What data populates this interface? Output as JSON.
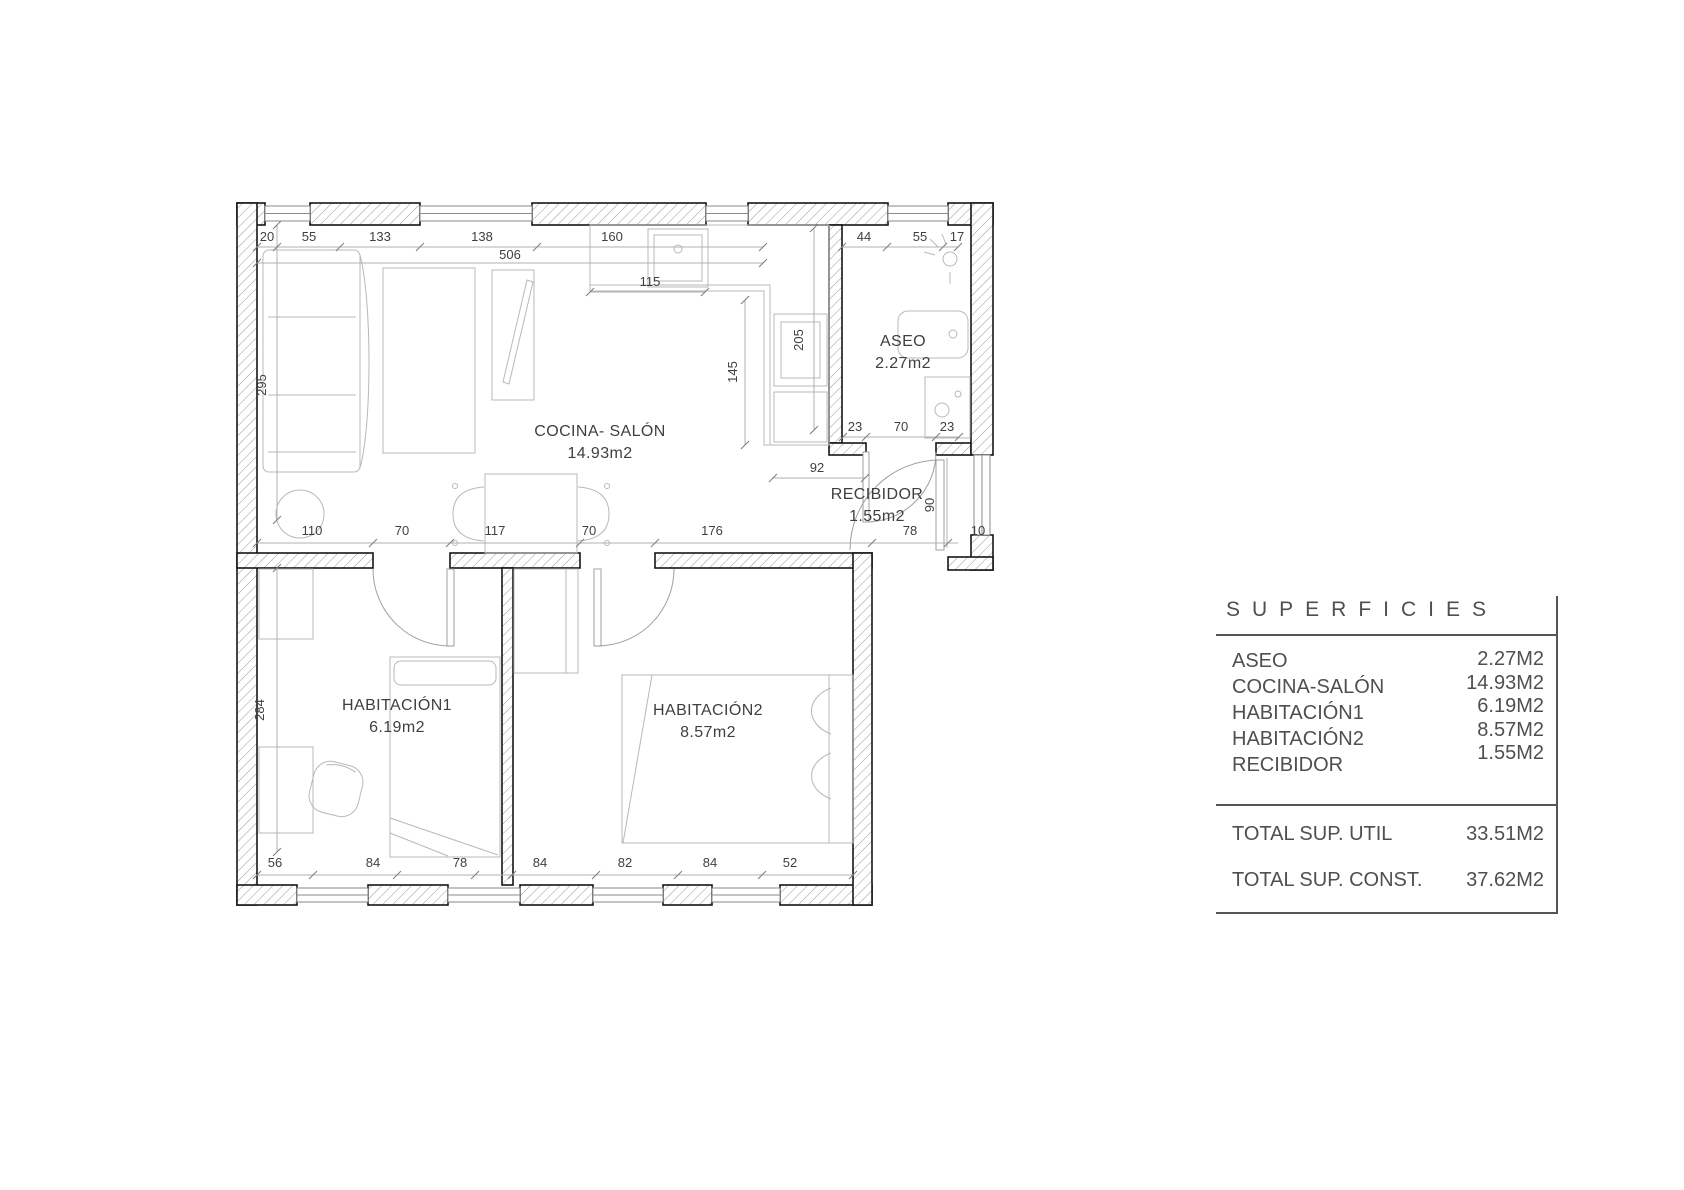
{
  "plan": {
    "rooms": {
      "cocina": {
        "name": "COCINA- SALÓN",
        "area": "14.93m2"
      },
      "aseo": {
        "name": "ASEO",
        "area": "2.27m2"
      },
      "recibidor": {
        "name": "RECIBIDOR",
        "area": "1.55m2"
      },
      "hab1": {
        "name": "HABITACIÓN1",
        "area": "6.19m2"
      },
      "hab2": {
        "name": "HABITACIÓN2",
        "area": "8.57m2"
      }
    },
    "dims": [
      "20",
      "55",
      "133",
      "138",
      "506",
      "160",
      "44",
      "55",
      "17",
      "295",
      "115",
      "205",
      "145",
      "23",
      "70",
      "23",
      "92",
      "90",
      "110",
      "70",
      "117",
      "70",
      "176",
      "78",
      "10",
      "284",
      "56",
      "84",
      "78",
      "84",
      "82",
      "84",
      "52"
    ]
  },
  "table": {
    "title": "SUPERFICIES",
    "rows": [
      {
        "label": "ASEO",
        "value": "2.27M2"
      },
      {
        "label": "COCINA-SALÓN",
        "value": "14.93M2"
      },
      {
        "label": "HABITACIÓN1",
        "value": "6.19M2"
      },
      {
        "label": "HABITACIÓN2",
        "value": "8.57M2"
      },
      {
        "label": "RECIBIDOR",
        "value": "1.55M2"
      }
    ],
    "totals": [
      {
        "label": "TOTAL SUP. UTIL",
        "value": "33.51M2"
      },
      {
        "label": "TOTAL SUP. CONST.",
        "value": "37.62M2"
      }
    ]
  }
}
